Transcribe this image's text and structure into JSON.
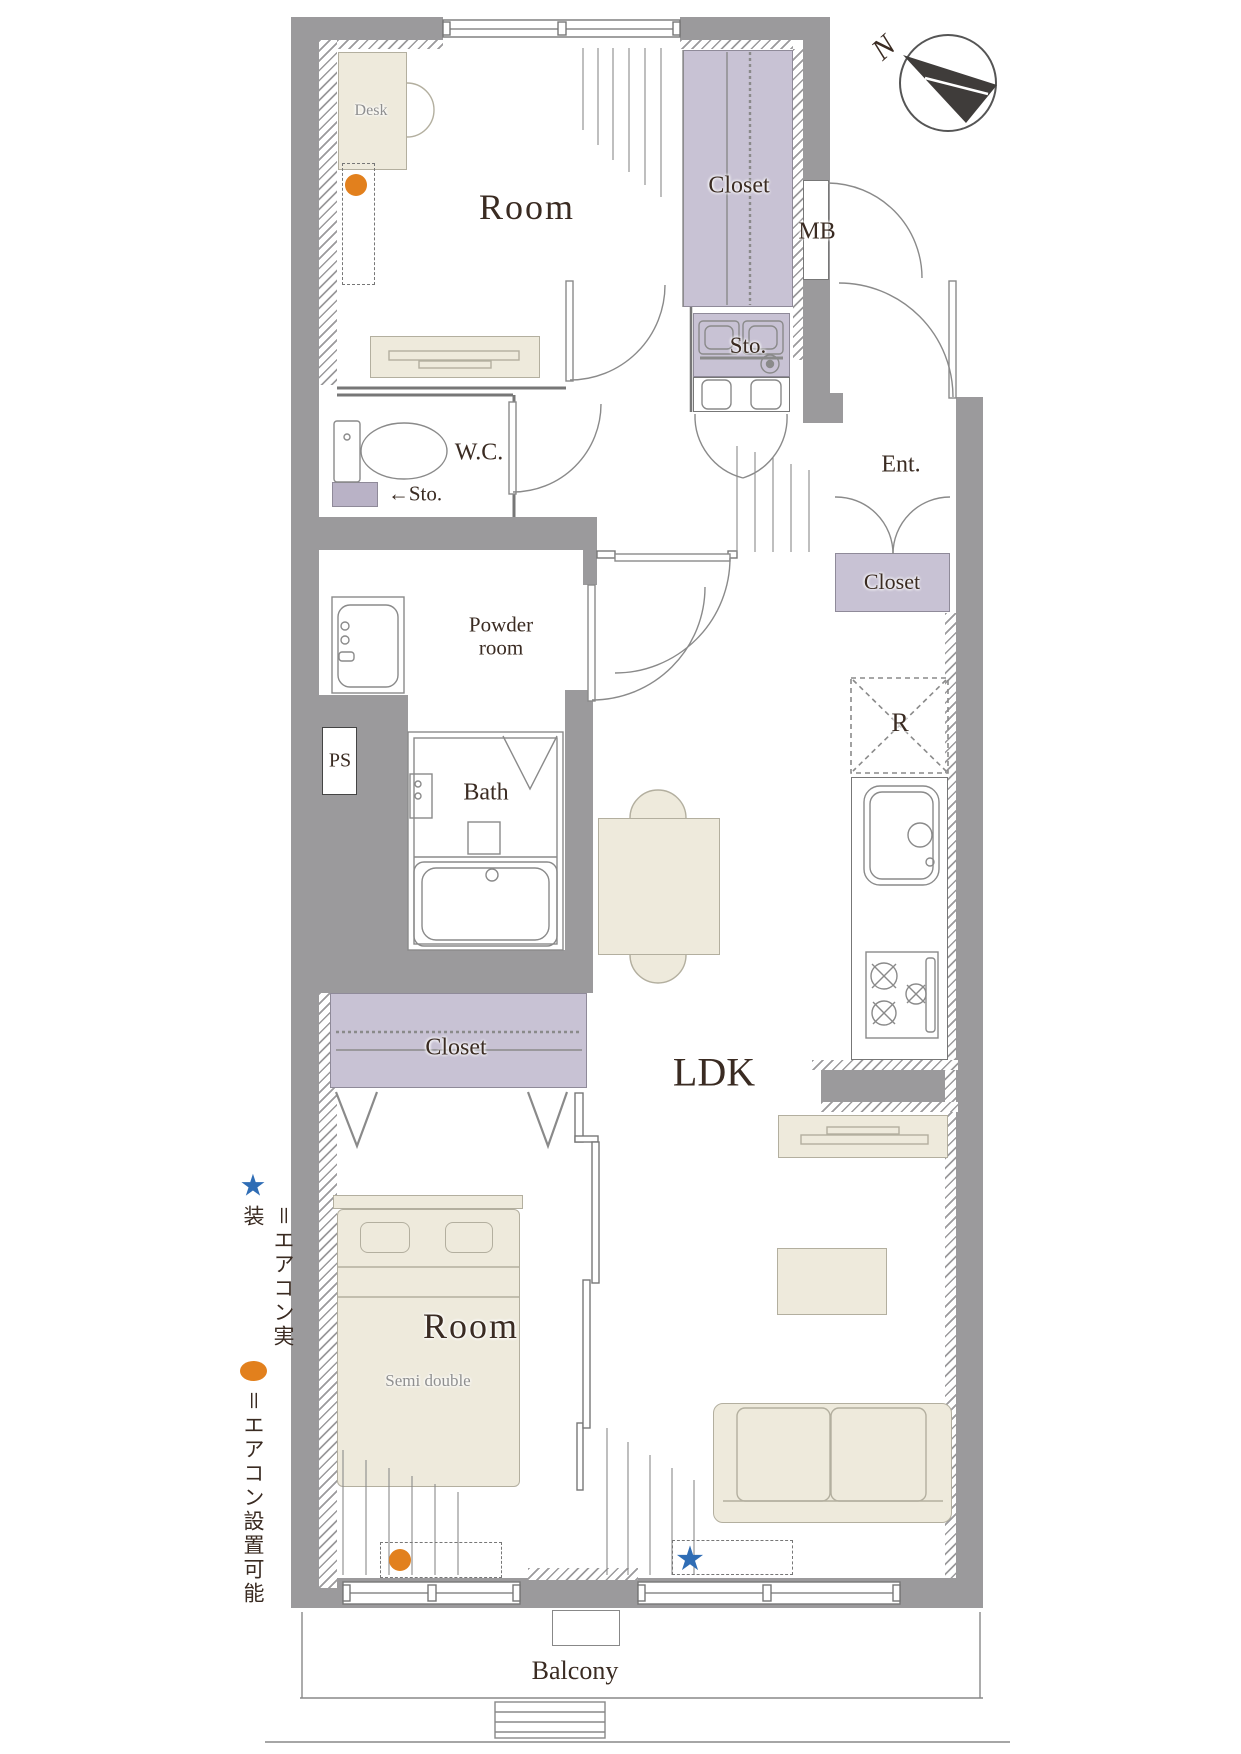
{
  "title": "2LDK apartment floor plan",
  "colors": {
    "wall": "#9b9a9c",
    "closet_fill": "#c8c2d4",
    "furniture_fill": "#eeeadc",
    "accent_orange": "#e2801d",
    "accent_blue": "#2f6db5",
    "text": "#3a2b22"
  },
  "compass": {
    "north_label": "N"
  },
  "rooms": {
    "room_top": {
      "label": "Room"
    },
    "desk": {
      "label": "Desk"
    },
    "closet_top": {
      "label": "Closet"
    },
    "meter_box": {
      "label": "MB"
    },
    "storage_top": {
      "label": "Sto."
    },
    "wc": {
      "label": "W.C."
    },
    "storage_wc": {
      "label": "←Sto."
    },
    "entrance": {
      "label": "Ent."
    },
    "closet_entrance": {
      "label": "Closet"
    },
    "powder": {
      "line1": "Powder",
      "line2": "room"
    },
    "pipe_space": {
      "label": "PS"
    },
    "bath": {
      "label": "Bath"
    },
    "refrigerator_space": {
      "label": "R"
    },
    "closet_middle": {
      "label": "Closet"
    },
    "ldk": {
      "label": "LDK"
    },
    "room_bottom": {
      "label": "Room",
      "sublabel": "Semi double"
    },
    "balcony": {
      "label": "Balcony"
    }
  },
  "markers": {
    "aircon_installed_symbol": "★",
    "aircon_possible_symbol": "●"
  },
  "legend": {
    "aircon_installed": {
      "symbol": "★",
      "text": "＝エアコン実装"
    },
    "aircon_possible": {
      "symbol": "●",
      "text": "＝エアコン設置可能"
    }
  }
}
